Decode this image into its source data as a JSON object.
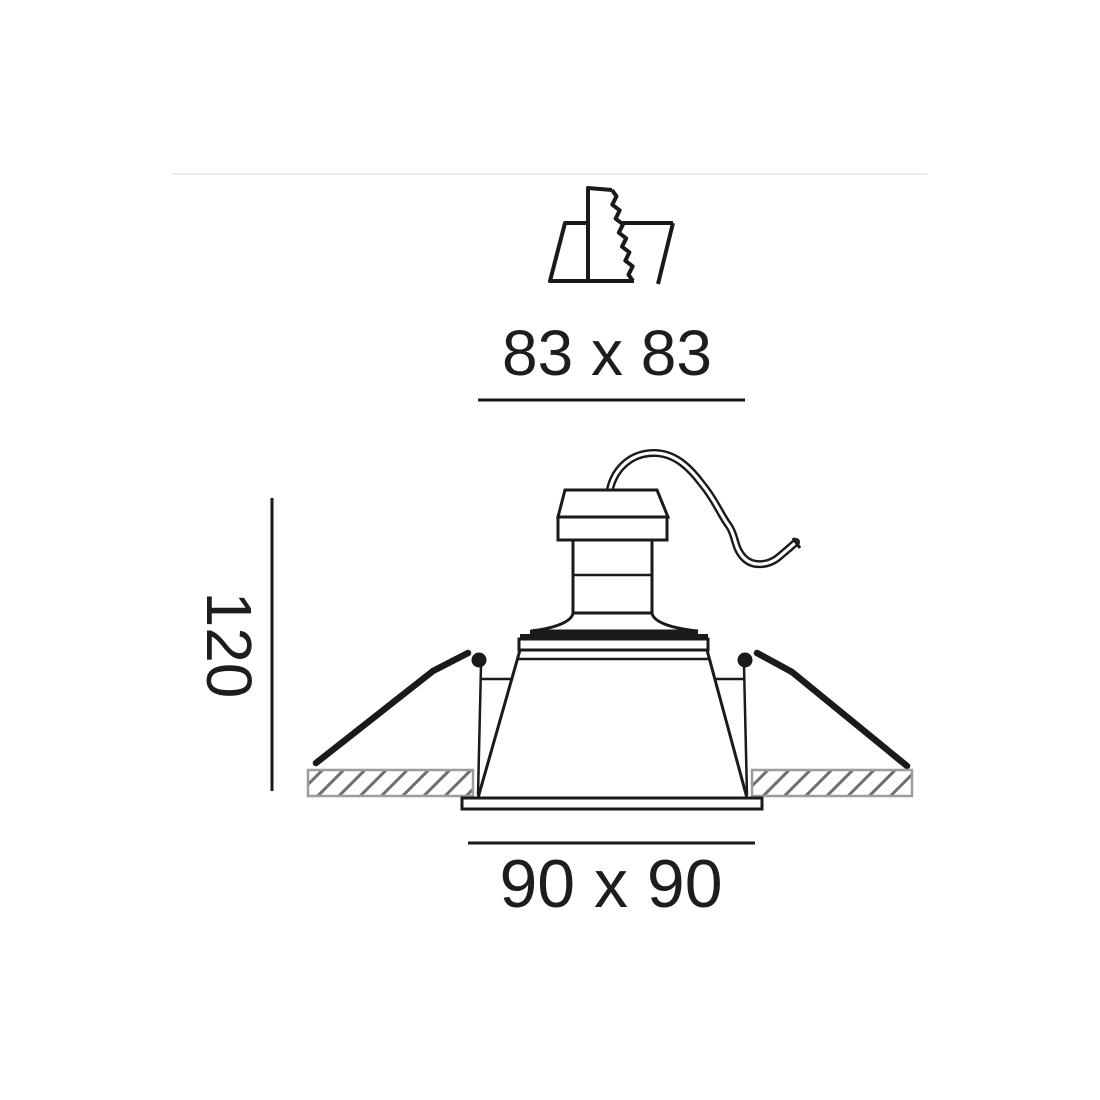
{
  "diagram": {
    "cutout_dimension_label": "83 x 83",
    "height_dimension_label": "120",
    "width_dimension_label": "90 x 90"
  },
  "icons": {
    "cutout_icon": "saw-ceiling-cutout-icon"
  },
  "colors": {
    "line": "#1a1a1a",
    "text": "#1d1d1d",
    "hatch_line": "#6f6f6f",
    "hatch_border": "#9d9d9d",
    "divider": "#ececec"
  }
}
